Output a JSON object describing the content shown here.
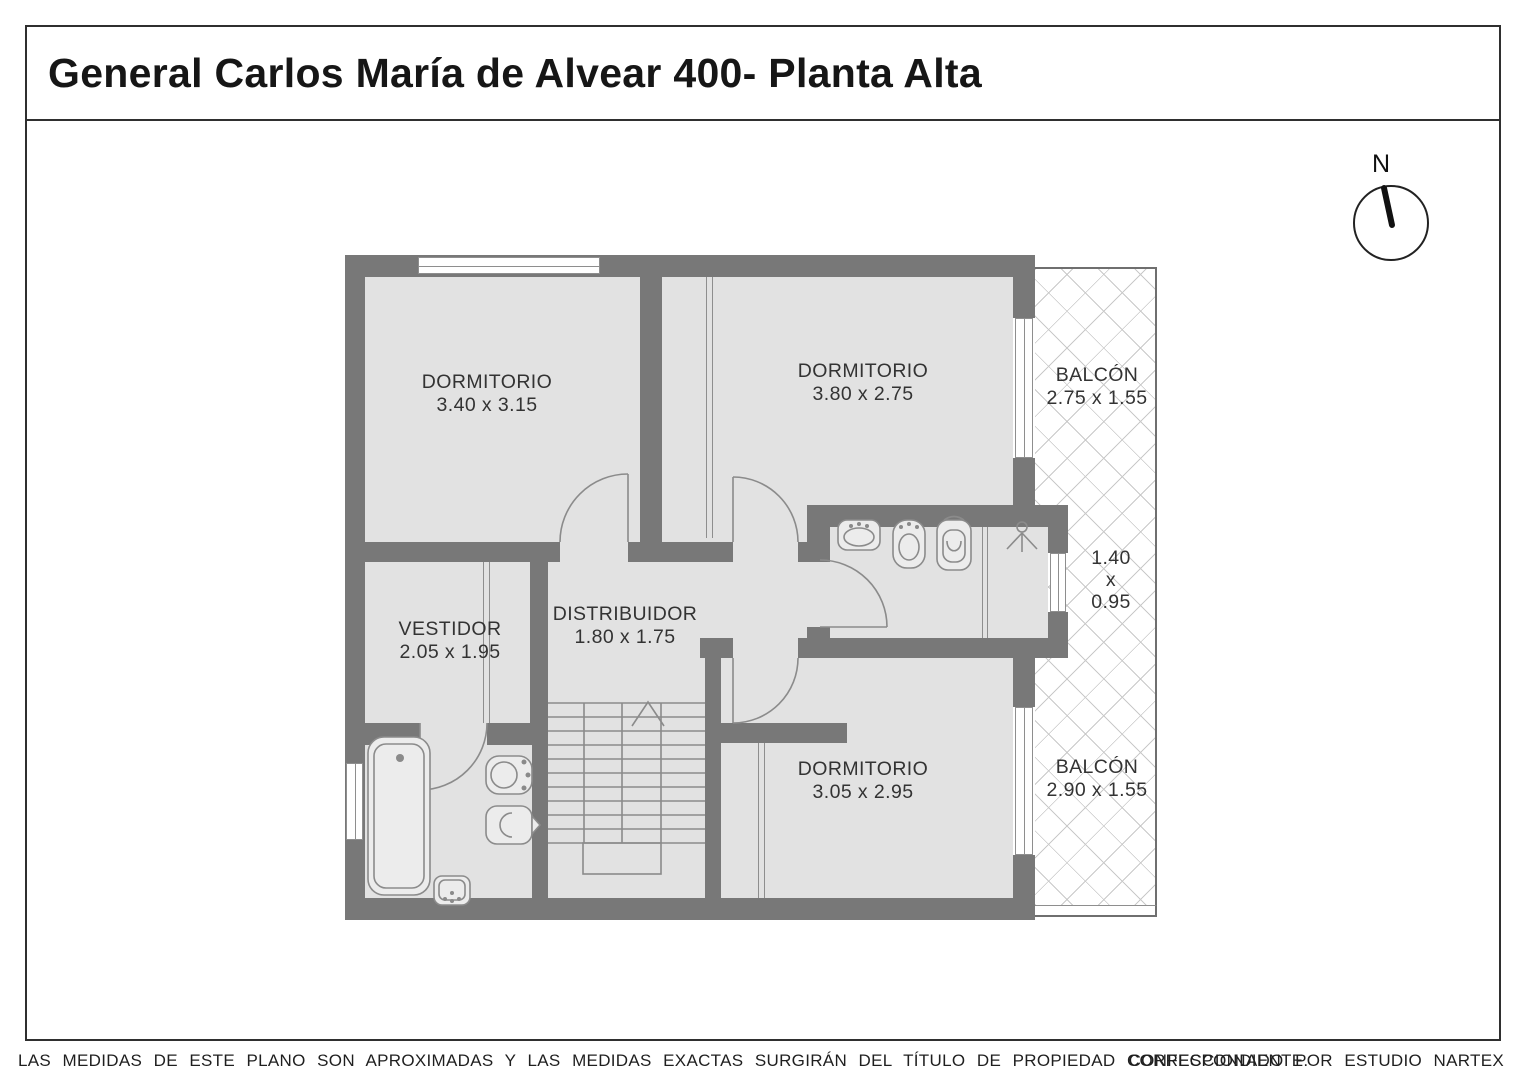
{
  "header": {
    "title": "General Carlos María de Alvear 400- Planta Alta"
  },
  "compass": {
    "label": "N"
  },
  "rooms": {
    "dorm1": {
      "name": "DORMITORIO",
      "dims": "3.40 x 3.15"
    },
    "dorm2": {
      "name": "DORMITORIO",
      "dims": "3.80 x 2.75"
    },
    "balcon1": {
      "name": "BALCÓN",
      "dims": "2.75 x 1.55"
    },
    "balcon_mid": {
      "l1": "1.40",
      "l2": "x",
      "l3": "0.95"
    },
    "vestidor": {
      "name": "VESTIDOR",
      "dims": "2.05 x 1.95"
    },
    "distribuidor": {
      "name": "DISTRIBUIDOR",
      "dims": "1.80 x 1.75"
    },
    "dorm3": {
      "name": "DORMITORIO",
      "dims": "3.05 x 2.95"
    },
    "balcon2": {
      "name": "BALCÓN",
      "dims": "2.90 x 1.55"
    }
  },
  "footer": {
    "disclaimer": "LAS MEDIDAS  DE ESTE PLANO SON APROXIMADAS Y LAS MEDIDAS EXACTAS SURGIRÁN DEL TÍTULO DE PROPIEDAD CORRESPONDIENTE.",
    "credit": "CONFECCIONADO POR ESTUDIO NARTEX"
  },
  "colors": {
    "wall": "#787878",
    "floor": "#e2e2e2",
    "lattice_line": "#c9c9c9",
    "text": "#333333"
  }
}
